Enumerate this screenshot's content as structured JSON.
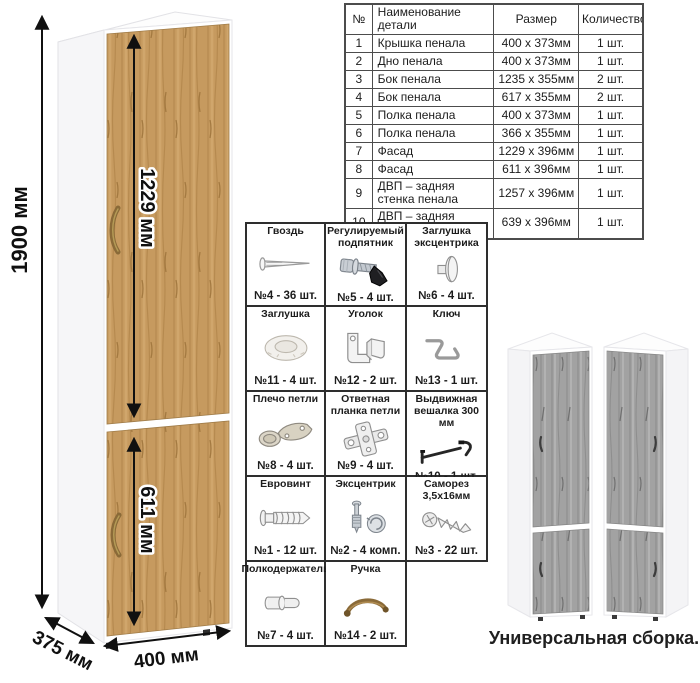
{
  "cabinet_diagram": {
    "height_label": "1900 мм",
    "upper_door_label": "1229 мм",
    "lower_door_label": "611 мм",
    "depth_label": "375 мм",
    "width_label": "400 мм",
    "wood_color": "#c69a5f",
    "handle_color": "#8a6a38"
  },
  "parts_table": {
    "headers": [
      "№",
      "Наименование детали",
      "Размер",
      "Количество"
    ],
    "rows": [
      [
        "1",
        "Крышка пенала",
        "400 х 373мм",
        "1 шт."
      ],
      [
        "2",
        "Дно пенала",
        "400 х 373мм",
        "1 шт."
      ],
      [
        "3",
        "Бок пенала",
        "1235 х 355мм",
        "2 шт."
      ],
      [
        "4",
        "Бок пенала",
        "617 х 355мм",
        "2 шт."
      ],
      [
        "5",
        "Полка пенала",
        "400 х 373мм",
        "1 шт."
      ],
      [
        "6",
        "Полка пенала",
        "366 х 355мм",
        "1 шт."
      ],
      [
        "7",
        "Фасад",
        "1229 х 396мм",
        "1 шт."
      ],
      [
        "8",
        "Фасад",
        "611 х 396мм",
        "1 шт."
      ],
      [
        "9",
        "ДВП – задняя стенка пенала",
        "1257 х 396мм",
        "1 шт."
      ],
      [
        "10",
        "ДВП – задняя стенка пенала",
        "639 х 396мм",
        "1 шт."
      ]
    ]
  },
  "hardware": {
    "items": [
      {
        "title": "Гвоздь",
        "icon": "nail-icon",
        "count": "№4 - 36 шт."
      },
      {
        "title": "Регулируемый подпятник",
        "icon": "adjustable-foot-icon",
        "count": "№5 - 4 шт."
      },
      {
        "title": "Заглушка эксцентрика",
        "icon": "cam-cover-icon",
        "count": "№6 - 4 шт."
      },
      {
        "title": "Заглушка",
        "icon": "cap-icon",
        "count": "№11 - 4 шт."
      },
      {
        "title": "Уголок",
        "icon": "corner-bracket-icon",
        "count": "№12 - 2 шт."
      },
      {
        "title": "Ключ",
        "icon": "hex-key-icon",
        "count": "№13 - 1 шт."
      },
      {
        "title": "Плечо петли",
        "icon": "hinge-arm-icon",
        "count": "№8 - 4 шт."
      },
      {
        "title": "Ответная планка петли",
        "icon": "hinge-plate-icon",
        "count": "№9 - 4 шт."
      },
      {
        "title": "Выдвижная вешалка 300 мм",
        "icon": "pullout-hanger-icon",
        "count": "№10 - 1 шт."
      },
      {
        "title": "Евровинт",
        "icon": "euro-screw-icon",
        "count": "№1 - 12 шт."
      },
      {
        "title": "Эксцентрик",
        "icon": "cam-lock-icon",
        "count": "№2 - 4 комп."
      },
      {
        "title": "Саморез 3,5х16мм",
        "icon": "self-tapping-screw-icon",
        "count": "№3 - 22 шт."
      },
      {
        "title": "Полкодержатель",
        "icon": "shelf-pin-icon",
        "count": "№7 - 4 шт."
      },
      {
        "title": "Ручка",
        "icon": "handle-icon",
        "count": "№14 - 2 шт."
      }
    ]
  },
  "variants": {
    "caption": "Универсальная сборка.",
    "gray_wood_color": "#a2a2a2"
  }
}
